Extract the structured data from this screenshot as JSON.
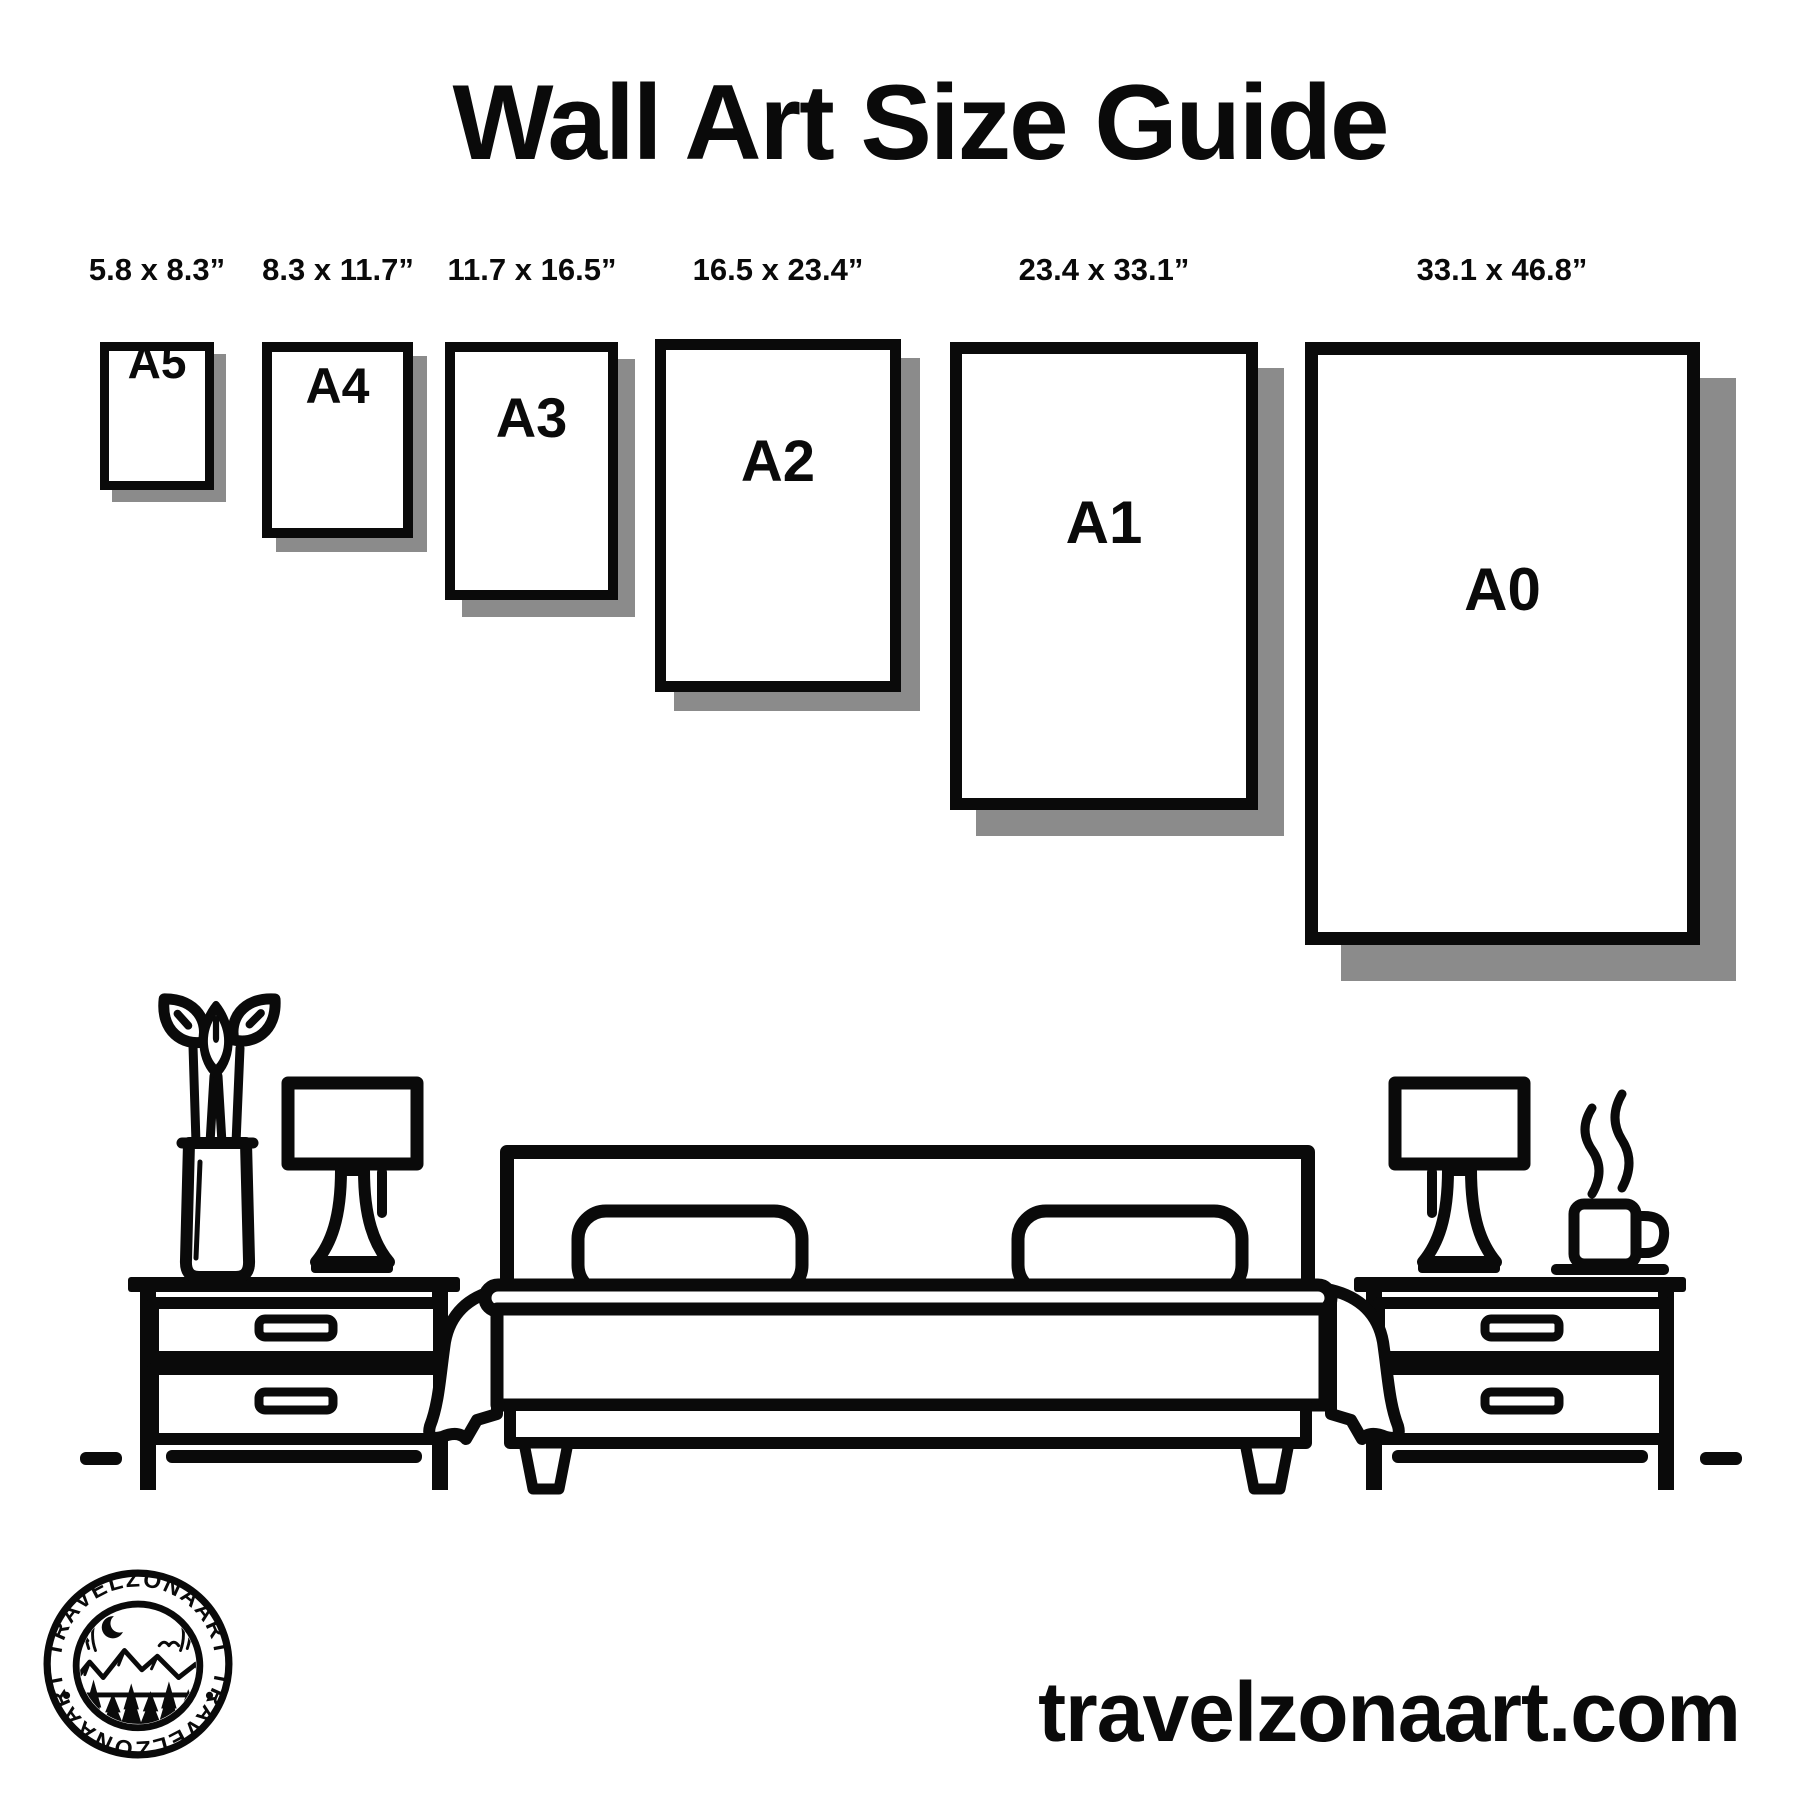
{
  "title": "Wall Art Size Guide",
  "size_guide": {
    "frames": [
      {
        "code": "A5",
        "dimensions": "5.8 x 8.3”"
      },
      {
        "code": "A4",
        "dimensions": "8.3 x 11.7”"
      },
      {
        "code": "A3",
        "dimensions": "11.7 x 16.5”"
      },
      {
        "code": "A2",
        "dimensions": "16.5 x 23.4”"
      },
      {
        "code": "A1",
        "dimensions": "23.4 x 33.1”"
      },
      {
        "code": "A0",
        "dimensions": "33.1 x 46.8”"
      }
    ]
  },
  "illustration": {
    "icons": [
      "plant-vase-icon",
      "table-lamp-icon",
      "nightstand-icon",
      "double-bed-icon",
      "pillow-icon",
      "coffee-mug-icon",
      "steam-icon",
      "floor-line-icon"
    ]
  },
  "logo": {
    "brand": "TRAVELZONAART",
    "brand_bottom": "TRAVELZONAART",
    "dot": "•",
    "icons": [
      "mountains-icon",
      "crescent-moon-icon",
      "bird-icon",
      "pine-tree-icon",
      "water-icon"
    ]
  },
  "footer": {
    "website": "travelzonaart.com"
  },
  "colors": {
    "ink": "#0a0a0a",
    "shadow": "#8b8b8b",
    "background": "#ffffff"
  }
}
